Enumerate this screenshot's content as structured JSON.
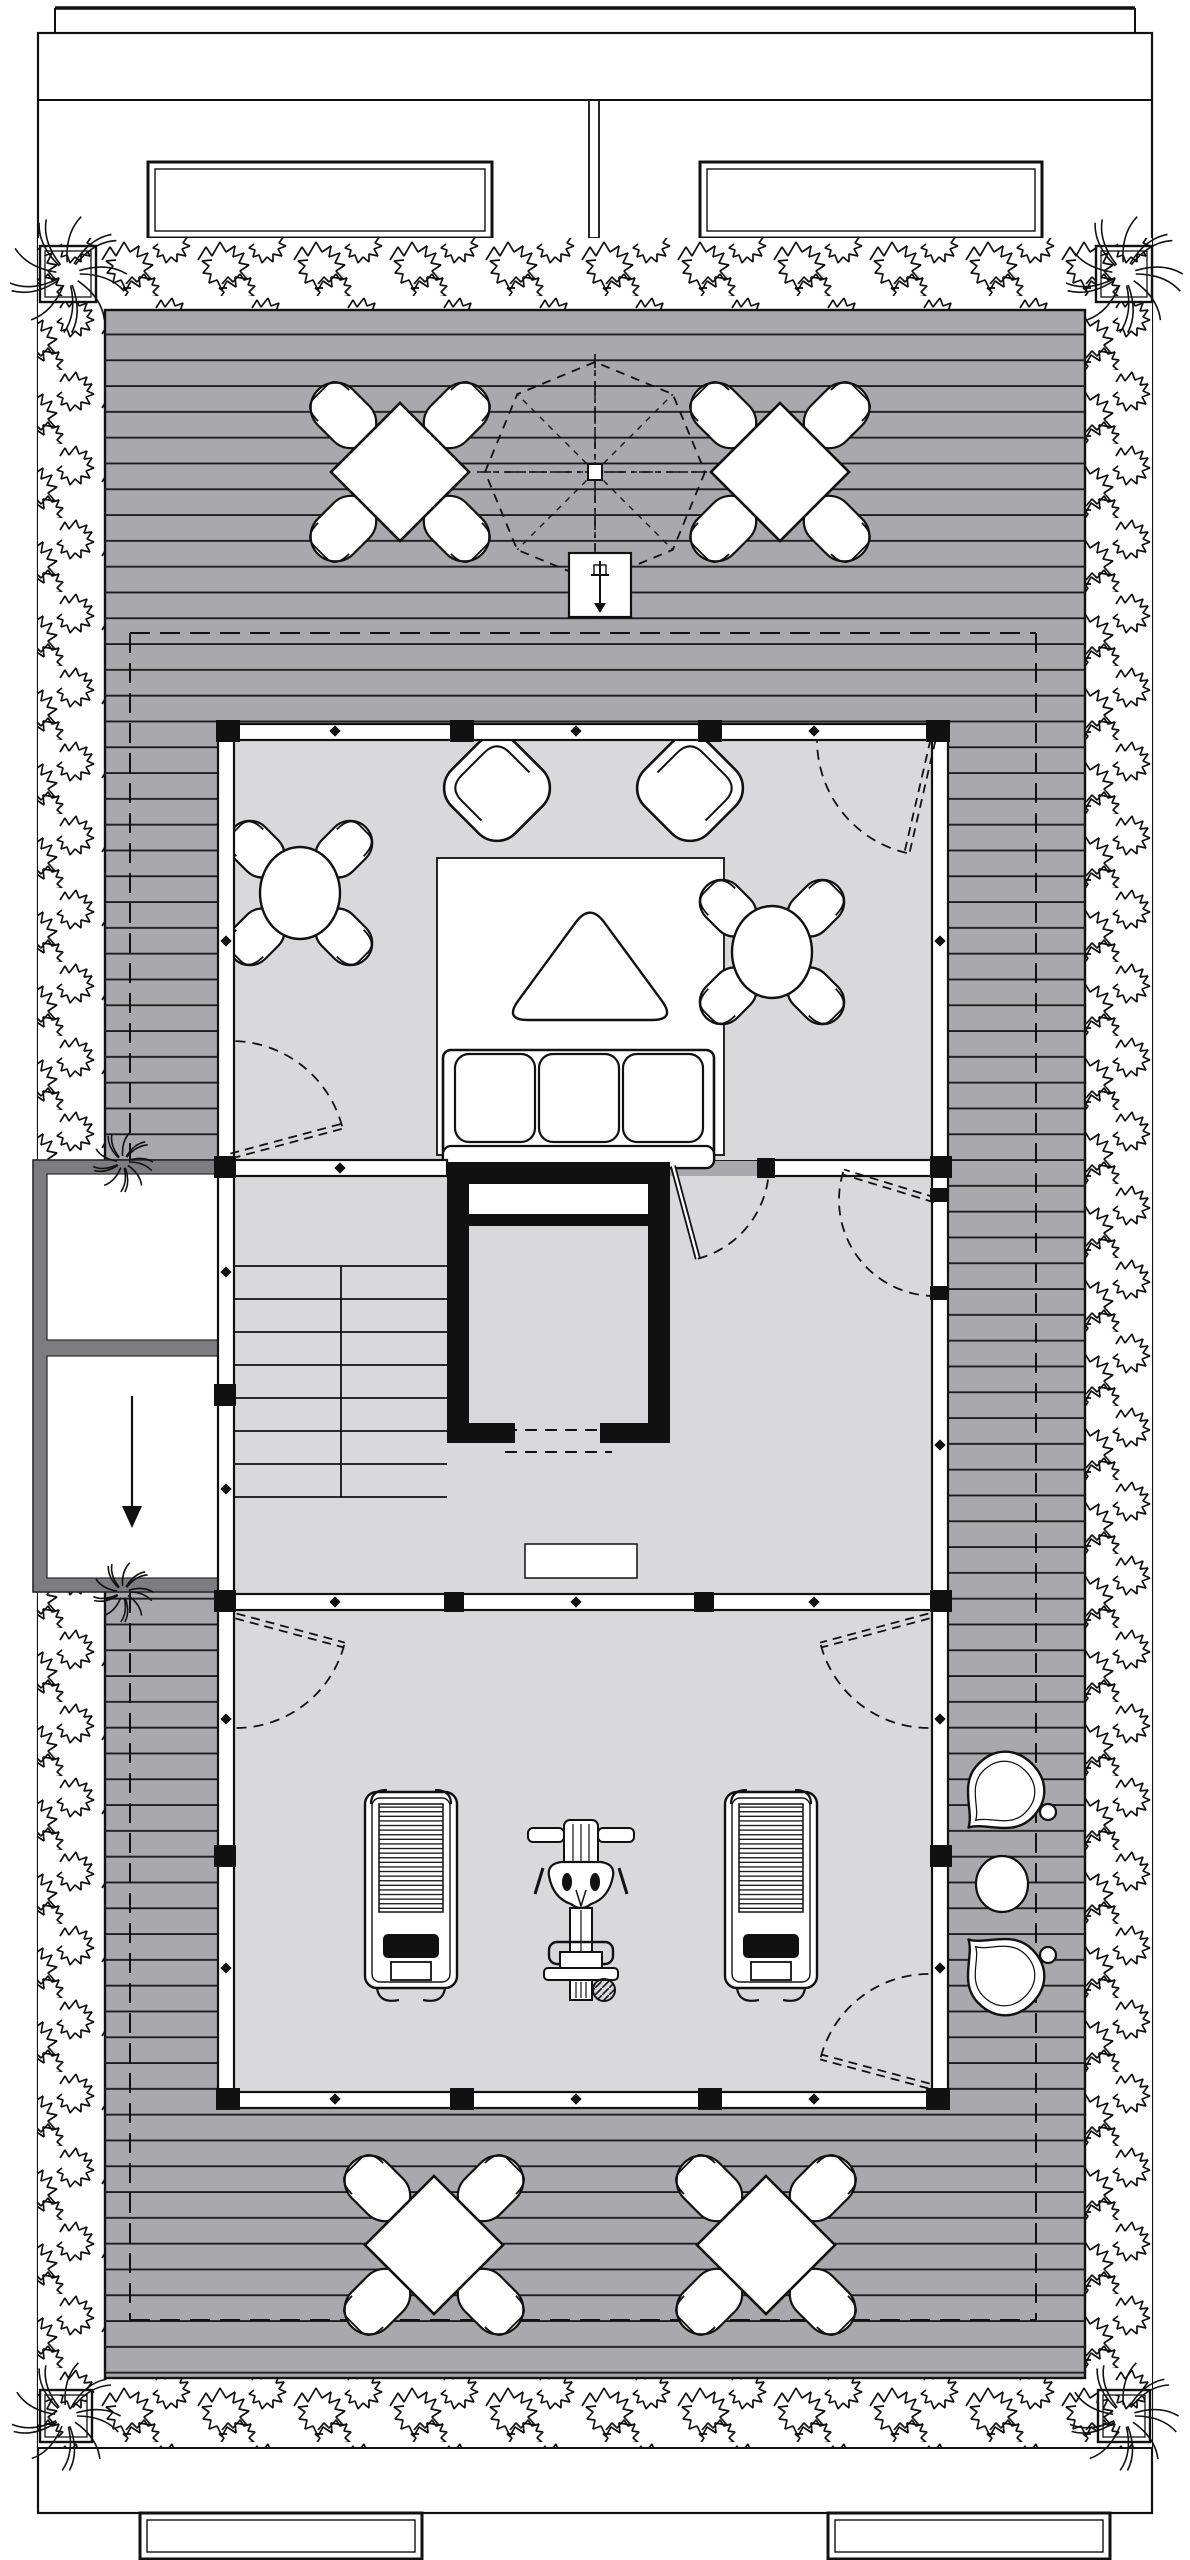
{
  "drawing": {
    "kind": "architectural-roof-terrace-floor-plan",
    "colors": {
      "paper": "#ffffff",
      "deck": "#a9a9ad",
      "board_line": "#1c1c1c",
      "room_floor": "#d9d9db",
      "dark_wall": "#7d7d81",
      "ink": "#111111"
    },
    "icons": [
      "down-arrow-icon",
      "umbrella-icon",
      "plant-hatch-icon"
    ],
    "counts": {
      "outdoor_dining_sets": 4,
      "lounge_armchairs": 2,
      "lounge_round_dining_sets": 2,
      "sofa_seats": 3,
      "treadmills": 2,
      "multi_gym_machines": 1,
      "deck_pin_chairs": 2,
      "corner_planters": 4,
      "stair_treads": 7,
      "doors": 7
    }
  },
  "layers": [
    {
      "t": "line",
      "n": "top-parapet-edge",
      "p": [
        55,
        8,
        1135,
        8
      ],
      "w": 3.5
    },
    {
      "t": "line",
      "n": "top-parapet-end-left",
      "p": [
        55,
        8,
        55,
        33
      ],
      "w": 2
    },
    {
      "t": "line",
      "n": "top-parapet-end-right",
      "p": [
        1135,
        8,
        1135,
        33
      ],
      "w": 2
    },
    {
      "t": "rect",
      "n": "site-boundary",
      "x": 38,
      "y": 33,
      "w": 1114,
      "h": 2480,
      "sw": 2.2
    },
    {
      "t": "line",
      "n": "upper-roof-edge",
      "p": [
        38,
        100,
        1152,
        100
      ],
      "w": 2
    },
    {
      "t": "line",
      "n": "party-wall-left-line",
      "p": [
        589,
        100,
        589,
        238
      ],
      "w": 1.8
    },
    {
      "t": "line",
      "n": "party-wall-right-line",
      "p": [
        599,
        100,
        599,
        238
      ],
      "w": 1.8
    },
    {
      "t": "line",
      "n": "party-wall-cap",
      "p": [
        589,
        238,
        599,
        238
      ],
      "w": 1.8
    },
    {
      "t": "rect",
      "n": "roof-skylight-left",
      "x": 148,
      "y": 162,
      "w": 344,
      "h": 76,
      "sw": 3,
      "fill": "#ffffff",
      "inner": 7
    },
    {
      "t": "rect",
      "n": "roof-skylight-right",
      "x": 700,
      "y": 162,
      "w": 342,
      "h": 76,
      "sw": 3,
      "fill": "#ffffff",
      "inner": 7
    },
    {
      "t": "rect",
      "n": "lower-roof-structure-left",
      "x": 140,
      "y": 2513,
      "w": 282,
      "h": 46,
      "sw": 3,
      "fill": "#ffffff",
      "inner": 7
    },
    {
      "t": "rect",
      "n": "lower-roof-structure-right",
      "x": 828,
      "y": 2513,
      "w": 282,
      "h": 46,
      "sw": 3,
      "fill": "#ffffff",
      "inner": 7
    },
    {
      "t": "rect",
      "n": "planting-bed-top",
      "x": 105,
      "y": 238,
      "w": 980,
      "h": 72,
      "fill": "#ffffff",
      "sw": 0,
      "pattern": "plants"
    },
    {
      "t": "rect",
      "n": "planting-bed-left",
      "x": 38,
      "y": 238,
      "w": 67,
      "h": 2210,
      "fill": "#ffffff",
      "sw": 0,
      "pattern": "plants"
    },
    {
      "t": "rect",
      "n": "planting-bed-right",
      "x": 1085,
      "y": 238,
      "w": 67,
      "h": 2210,
      "fill": "#ffffff",
      "sw": 0,
      "pattern": "plants"
    },
    {
      "t": "rect",
      "n": "planting-bed-bottom",
      "x": 105,
      "y": 2378,
      "w": 980,
      "h": 70,
      "fill": "#ffffff",
      "sw": 0,
      "pattern": "plants"
    },
    {
      "t": "line",
      "n": "planting-bed-bottom-edge",
      "p": [
        38,
        2448,
        1152,
        2448
      ],
      "w": 2
    },
    {
      "t": "rect",
      "n": "timber-deck",
      "x": 105,
      "y": 310,
      "w": 980,
      "h": 2068,
      "fill": "#a9a9ad",
      "sw": 2.4,
      "pattern": "boards"
    },
    {
      "t": "line",
      "n": "floor-below-outline-top",
      "p": [
        130,
        633,
        1036,
        633
      ],
      "w": 2,
      "dash": "20 10"
    },
    {
      "t": "line",
      "n": "floor-below-outline-bottom",
      "p": [
        130,
        2320,
        1036,
        2320
      ],
      "w": 2,
      "dash": "20 10"
    },
    {
      "t": "line",
      "n": "floor-below-outline-left",
      "p": [
        130,
        633,
        130,
        2320
      ],
      "w": 2,
      "dash": "20 10"
    },
    {
      "t": "line",
      "n": "floor-below-outline-right",
      "p": [
        1036,
        633,
        1036,
        2320
      ],
      "w": 2,
      "dash": "20 10"
    },
    {
      "t": "rect",
      "n": "service-annex",
      "x": 33,
      "y": 1160,
      "w": 199,
      "h": 432,
      "fill": "#7d7d81",
      "stroke": "#2a2a2a",
      "sw": 1.6
    },
    {
      "t": "rect",
      "n": "annex-room-upper",
      "x": 47,
      "y": 1174,
      "w": 171,
      "h": 166,
      "fill": "#ffffff",
      "stroke": "#2a2a2a",
      "sw": 1.2
    },
    {
      "t": "rect",
      "n": "annex-room-lower",
      "x": 47,
      "y": 1356,
      "w": 171,
      "h": 222,
      "fill": "#ffffff",
      "stroke": "#2a2a2a",
      "sw": 1.2
    },
    {
      "t": "arrow",
      "n": "down-arrow-icon",
      "p": [
        132,
        1396,
        132,
        1514
      ],
      "head": 14
    },
    {
      "t": "rect",
      "n": "lounge-floor",
      "x": 234,
      "y": 740,
      "w": 698,
      "h": 420,
      "fill": "#d9d9db",
      "sw": 0
    },
    {
      "t": "rect",
      "n": "core-floor",
      "x": 234,
      "y": 1176,
      "w": 698,
      "h": 418,
      "fill": "#d9d9db",
      "sw": 0
    },
    {
      "t": "rect",
      "n": "gym-floor",
      "x": 234,
      "y": 1610,
      "w": 698,
      "h": 482,
      "fill": "#d9d9db",
      "sw": 0
    },
    {
      "t": "stair",
      "n": "staircase",
      "x1": 234,
      "x2": 447,
      "yTop": 1266,
      "step": 33,
      "treadLines": 8,
      "centerX": 341
    },
    {
      "t": "rect",
      "n": "core-doormat",
      "x": 525,
      "y": 1544,
      "w": 112,
      "h": 34,
      "fill": "#ffffff",
      "sw": 1.5
    },
    {
      "t": "rect",
      "n": "lounge-rug",
      "x": 437,
      "y": 858,
      "w": 287,
      "h": 297,
      "fill": "#ffffff",
      "sw": 1.8
    },
    {
      "t": "armchair",
      "n": "lounge-armchair-left",
      "cx": 497,
      "cy": 788,
      "rot": -45
    },
    {
      "t": "armchair",
      "n": "lounge-armchair-right",
      "cx": 690,
      "cy": 788,
      "rot": 45
    },
    {
      "t": "coffee",
      "n": "triangle-coffee-table",
      "pts": [
        [
          590,
          903
        ],
        [
          676,
          1020
        ],
        [
          504,
          1020
        ]
      ],
      "r": 24
    },
    {
      "t": "sofa",
      "n": "three-seat-sofa",
      "x": 443,
      "y": 1050,
      "w": 271,
      "h": 118
    },
    {
      "t": "dining_r",
      "n": "lounge-table-set-left",
      "cx": 300,
      "cy": 893
    },
    {
      "t": "dining_r",
      "n": "lounge-table-set-right",
      "cx": 772,
      "cy": 952
    },
    {
      "t": "treadmill",
      "n": "treadmill-left",
      "x": 365,
      "y": 1788
    },
    {
      "t": "treadmill",
      "n": "treadmill-right",
      "x": 725,
      "y": 1788
    },
    {
      "t": "multigym",
      "n": "multi-gym-machine",
      "cx": 581,
      "y": 1820
    },
    {
      "t": "rect",
      "n": "glass-wall-top",
      "x": 218,
      "y": 724,
      "w": 730,
      "h": 16,
      "fill": "#ffffff",
      "sw": 2.2
    },
    {
      "t": "rect",
      "n": "glass-wall-left",
      "x": 218,
      "y": 724,
      "w": 16,
      "h": 1384,
      "fill": "#ffffff",
      "sw": 2.2
    },
    {
      "t": "rect",
      "n": "glass-wall-right",
      "x": 932,
      "y": 724,
      "w": 16,
      "h": 1384,
      "fill": "#ffffff",
      "sw": 2.2
    },
    {
      "t": "rect",
      "n": "glass-wall-bottom",
      "x": 218,
      "y": 2092,
      "w": 730,
      "h": 16,
      "fill": "#ffffff",
      "sw": 2.2
    },
    {
      "t": "rect",
      "n": "glass-wall-divider-lounge-a",
      "x": 234,
      "y": 1160,
      "w": 213,
      "h": 16,
      "fill": "#ffffff",
      "sw": 2.2
    },
    {
      "t": "rect",
      "n": "glass-wall-divider-lounge-b",
      "x": 769,
      "y": 1160,
      "w": 163,
      "h": 16,
      "fill": "#ffffff",
      "sw": 2.2
    },
    {
      "t": "rect",
      "n": "glass-wall-divider-gym",
      "x": 234,
      "y": 1594,
      "w": 698,
      "h": 16,
      "fill": "#ffffff",
      "sw": 2.2
    },
    {
      "t": "blocks",
      "n": "wall-mullion-block",
      "list": [
        [
          216,
          720,
          24,
          22
        ],
        [
          450,
          720,
          24,
          22
        ],
        [
          698,
          720,
          24,
          22
        ],
        [
          926,
          720,
          24,
          22
        ],
        [
          216,
          2088,
          24,
          22
        ],
        [
          450,
          2088,
          24,
          22
        ],
        [
          698,
          2088,
          24,
          22
        ],
        [
          926,
          2088,
          24,
          22
        ],
        [
          214,
          1156,
          22,
          22
        ],
        [
          214,
          1384,
          22,
          22
        ],
        [
          214,
          1590,
          22,
          22
        ],
        [
          214,
          1845,
          22,
          22
        ],
        [
          930,
          1156,
          22,
          22
        ],
        [
          930,
          1188,
          18,
          14
        ],
        [
          930,
          1286,
          18,
          14
        ],
        [
          930,
          1590,
          22,
          22
        ],
        [
          930,
          1845,
          22,
          22
        ],
        [
          444,
          1592,
          20,
          20
        ],
        [
          694,
          1592,
          20,
          20
        ],
        [
          757,
          1158,
          18,
          20
        ]
      ]
    },
    {
      "t": "dots",
      "n": "wall-mullion-dot",
      "list": [
        [
          335,
          731
        ],
        [
          576,
          731
        ],
        [
          814,
          731
        ],
        [
          335,
          2099
        ],
        [
          576,
          2099
        ],
        [
          814,
          2099
        ],
        [
          226,
          941
        ],
        [
          226,
          1272
        ],
        [
          226,
          1489
        ],
        [
          226,
          1719
        ],
        [
          226,
          1968
        ],
        [
          940,
          941
        ],
        [
          940,
          1445
        ],
        [
          940,
          1719
        ],
        [
          940,
          1968
        ],
        [
          340,
          1168
        ],
        [
          335,
          1602
        ],
        [
          576,
          1602
        ],
        [
          814,
          1602
        ]
      ]
    },
    {
      "t": "rect",
      "n": "elevator-shaft",
      "x": 447,
      "y": 1162,
      "w": 223,
      "h": 281,
      "fill": "#111111",
      "sw": 0
    },
    {
      "t": "rect",
      "n": "elevator-machine-slot",
      "x": 469,
      "y": 1184,
      "w": 179,
      "h": 30,
      "fill": "#ffffff",
      "sw": 0
    },
    {
      "t": "rect",
      "n": "elevator-cab",
      "x": 469,
      "y": 1226,
      "w": 179,
      "h": 197,
      "fill": "#d9d9db",
      "sw": 0
    },
    {
      "t": "rect",
      "n": "elevator-door-gap",
      "x": 515,
      "y": 1423,
      "w": 85,
      "h": 20,
      "fill": "#d9d9db",
      "sw": 0
    },
    {
      "t": "line",
      "n": "elevator-door-dash-1",
      "p": [
        505,
        1430,
        612,
        1430
      ],
      "w": 2,
      "dash": "12 8"
    },
    {
      "t": "line",
      "n": "elevator-door-dash-2",
      "p": [
        505,
        1452,
        612,
        1452
      ],
      "w": 2,
      "dash": "12 8"
    },
    {
      "t": "door",
      "n": "door-lounge-terrace",
      "hinge": [
        933,
        740
      ],
      "r": 116,
      "leaf": 103,
      "from": 103,
      "to": 180
    },
    {
      "t": "door",
      "n": "door-lounge-core",
      "hinge": [
        231,
        1156
      ],
      "r": 115,
      "leaf": 345,
      "from": 345,
      "to": 270
    },
    {
      "t": "door",
      "n": "door-core-lobby",
      "hinge": [
        673,
        1166
      ],
      "r": 96,
      "leaf": 75,
      "from": 75,
      "to": 0,
      "solid": true
    },
    {
      "t": "door",
      "n": "door-lobby-terrace",
      "hinge": [
        935,
        1200
      ],
      "r": 96,
      "leaf": 197,
      "from": 197,
      "to": 90
    },
    {
      "t": "door",
      "n": "door-gym-northwest",
      "hinge": [
        236,
        1616
      ],
      "r": 112,
      "leaf": 15,
      "from": 15,
      "to": 90
    },
    {
      "t": "door",
      "n": "door-gym-northeast",
      "hinge": [
        929,
        1616
      ],
      "r": 112,
      "leaf": 165,
      "from": 165,
      "to": 90
    },
    {
      "t": "door",
      "n": "door-gym-southeast",
      "hinge": [
        929,
        2086
      ],
      "r": 112,
      "leaf": 195,
      "from": 195,
      "to": 270
    },
    {
      "t": "dining_d",
      "n": "terrace-dining-set-1",
      "cx": 400,
      "cy": 472
    },
    {
      "t": "dining_d",
      "n": "terrace-dining-set-2",
      "cx": 780,
      "cy": 472
    },
    {
      "t": "dining_d",
      "n": "terrace-dining-set-3",
      "cx": 434,
      "cy": 2245
    },
    {
      "t": "dining_d",
      "n": "terrace-dining-set-4",
      "cx": 766,
      "cy": 2245
    },
    {
      "t": "umbrella",
      "n": "umbrella-icon",
      "cx": 595,
      "cy": 472,
      "r": 110,
      "base": [
        569,
        553,
        62,
        64
      ]
    },
    {
      "t": "pin",
      "n": "deck-pin-chair-upper",
      "cx": 1001,
      "cy": 1795,
      "rot": 45
    },
    {
      "t": "pin",
      "n": "deck-pin-chair-lower",
      "cx": 1001,
      "cy": 1972,
      "rot": 135
    },
    {
      "t": "ellipse",
      "n": "deck-side-table",
      "cx": 1002,
      "cy": 1884,
      "rx": 26,
      "ry": 28
    },
    {
      "t": "ellipse",
      "n": "deck-pin-ring-upper",
      "cx": 1048,
      "cy": 1812,
      "rx": 8,
      "ry": 8
    },
    {
      "t": "ellipse",
      "n": "deck-pin-ring-lower",
      "cx": 1048,
      "cy": 1955,
      "rx": 8,
      "ry": 8
    },
    {
      "t": "planter",
      "n": "corner-planter-nw",
      "x": 40,
      "y": 246,
      "s": 56
    },
    {
      "t": "planter",
      "n": "corner-planter-ne",
      "x": 1096,
      "y": 246,
      "s": 56
    },
    {
      "t": "planter",
      "n": "corner-planter-sw",
      "x": 40,
      "y": 2390,
      "s": 52
    },
    {
      "t": "planter",
      "n": "corner-planter-se",
      "x": 1098,
      "y": 2390,
      "s": 52
    },
    {
      "t": "burst",
      "n": "annex-planting-upper",
      "cx": 123,
      "cy": 1162,
      "r": 30
    },
    {
      "t": "burst",
      "n": "annex-planting-lower",
      "cx": 123,
      "cy": 1592,
      "r": 30
    }
  ]
}
